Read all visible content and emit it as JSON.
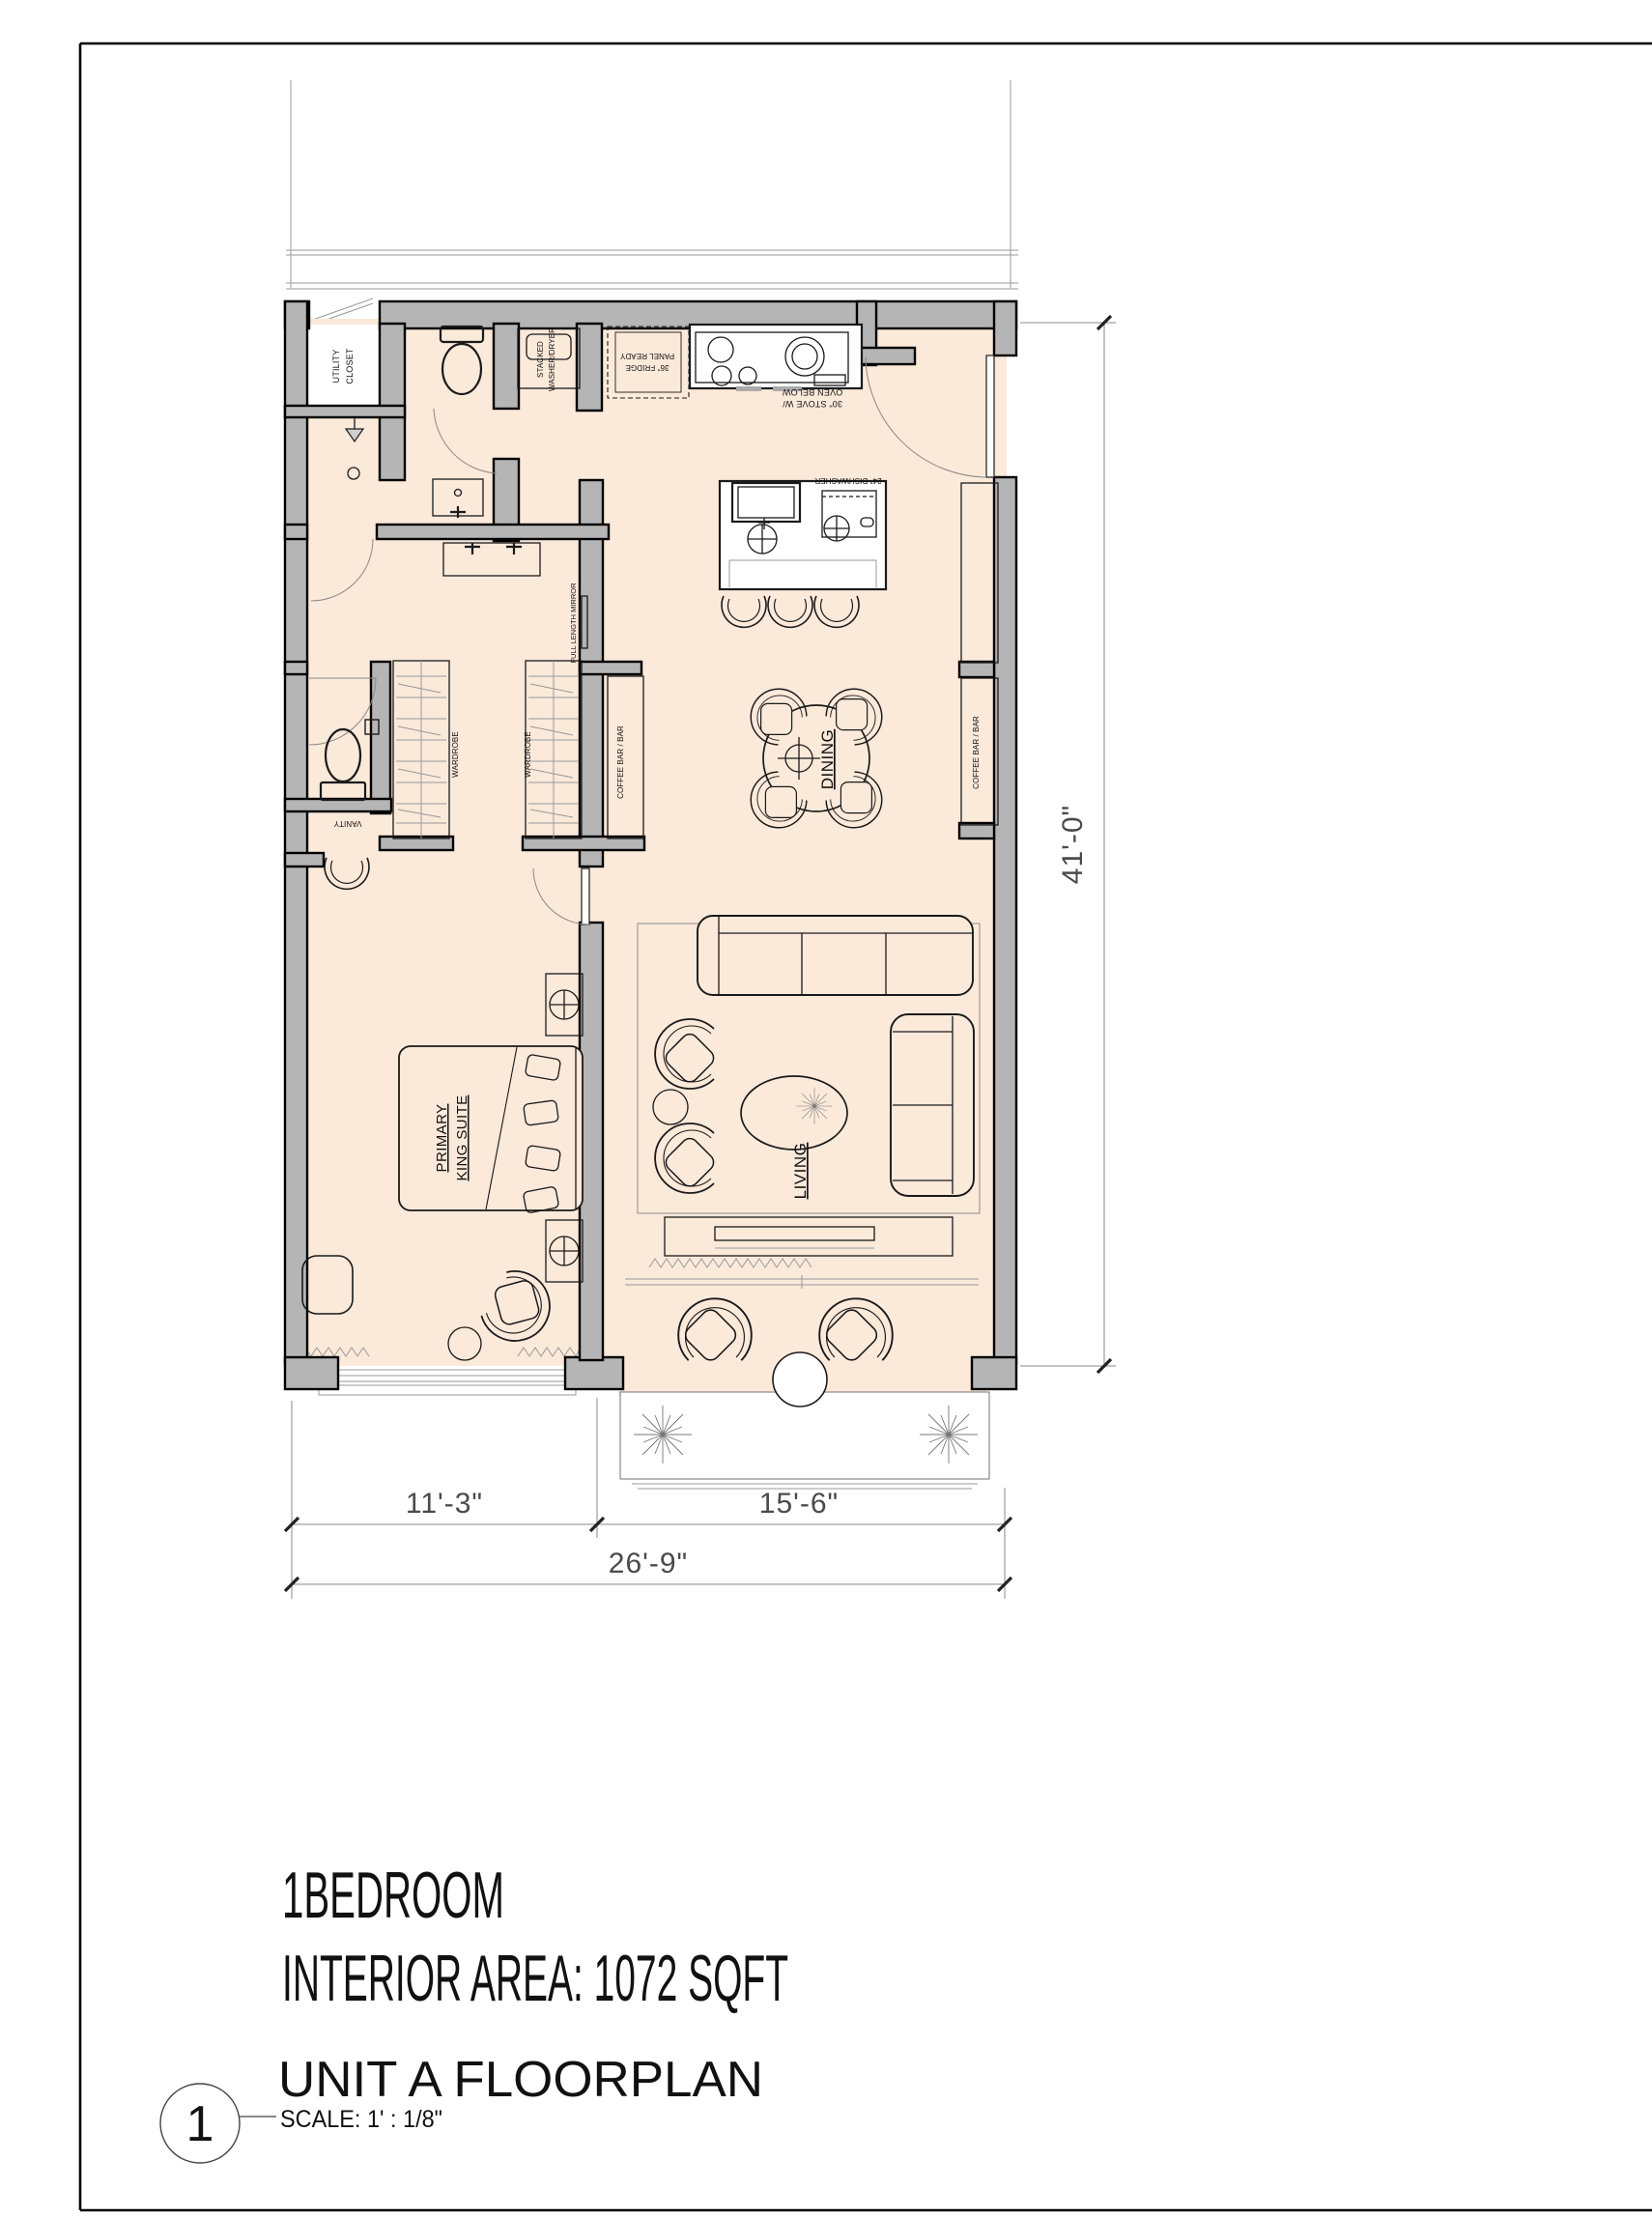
{
  "labels": {
    "utility_closet_1": "UTILITY",
    "utility_closet_2": "CLOSET",
    "washer_1": "STACKED",
    "washer_2": "WASHER/DRYER",
    "fridge_1": "36\" FRIDGE",
    "fridge_2": "PANEL READY",
    "stove_1": "30\" STOVE W/",
    "stove_2": "OVEN BELOW",
    "dishwasher": "24\" DISHWASHER",
    "mirror": "FULL LENGTH MIRROR",
    "wardrobe_left": "WARDROBE",
    "wardrobe_right": "WARDROBE",
    "coffee_bar_left": "COFFEE BAR / BAR",
    "coffee_bar_right": "COFFEE BAR / BAR",
    "dining": "DINING",
    "living": "LIVING",
    "primary_1": "PRIMARY",
    "primary_2": "KING SUITE",
    "vanity": "VANITY"
  },
  "dimensions": {
    "height_total": "41'-0\"",
    "width_bedroom": "11'-3\"",
    "width_living": "15'-6\"",
    "width_total": "26'-9\""
  },
  "area_title": {
    "line1": "1BEDROOM",
    "line2": "INTERIOR AREA: 1072 SQFT"
  },
  "sheet": {
    "number": "1",
    "name": "UNIT A FLOORPLAN",
    "scale": "SCALE:   1' : 1/8\""
  },
  "colors": {
    "floor": "#fbe9da",
    "wall_fill": "#b5b5b5",
    "line": "#1a1a1a"
  }
}
